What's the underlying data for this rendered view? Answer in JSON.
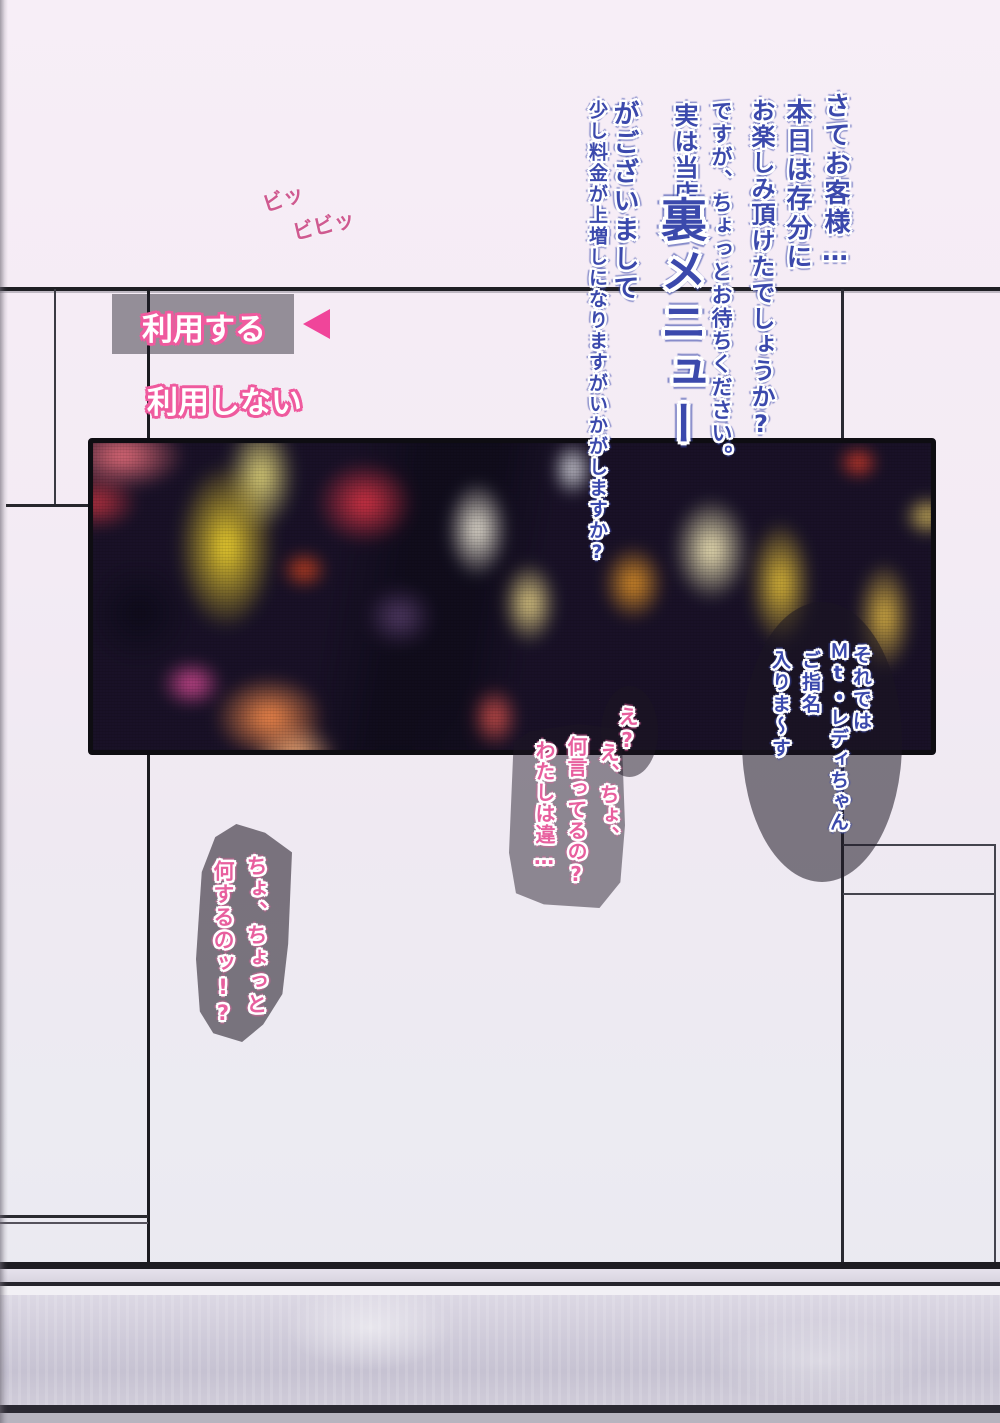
{
  "narration": {
    "lines": [
      "さてお客様…",
      "本日は存分に",
      "お楽しみ頂けたでしょうか?",
      "ですが、ちょっとお待ちください。",
      "実は当店、",
      "裏メニュー",
      "がございまして",
      "少し料金が上増しになりますがいかがしますか?"
    ]
  },
  "sfx": {
    "beep1": "ビッ",
    "beep2": "ビビッ"
  },
  "menu": {
    "use": "利用する",
    "not_use": "利用しない"
  },
  "bubbles": {
    "announce": {
      "cols": [
        "それでは",
        "Ｍt・レディちゃん",
        "ご指名",
        "入りま〜す"
      ]
    },
    "eh": {
      "text": "え?"
    },
    "protest": {
      "cols": [
        "え、ちょ、",
        "何言ってるの?",
        "わたしは違…"
      ]
    },
    "grab": {
      "cols": [
        "ちょ、ちょっと",
        "何するのッ!?"
      ]
    }
  },
  "photo": {
    "description": "blurred neon signs of a night entertainment district"
  },
  "colors": {
    "accent_pink": "#f0459a",
    "text_blue": "#3b49ac",
    "bubble_gray": "#8b8591"
  }
}
